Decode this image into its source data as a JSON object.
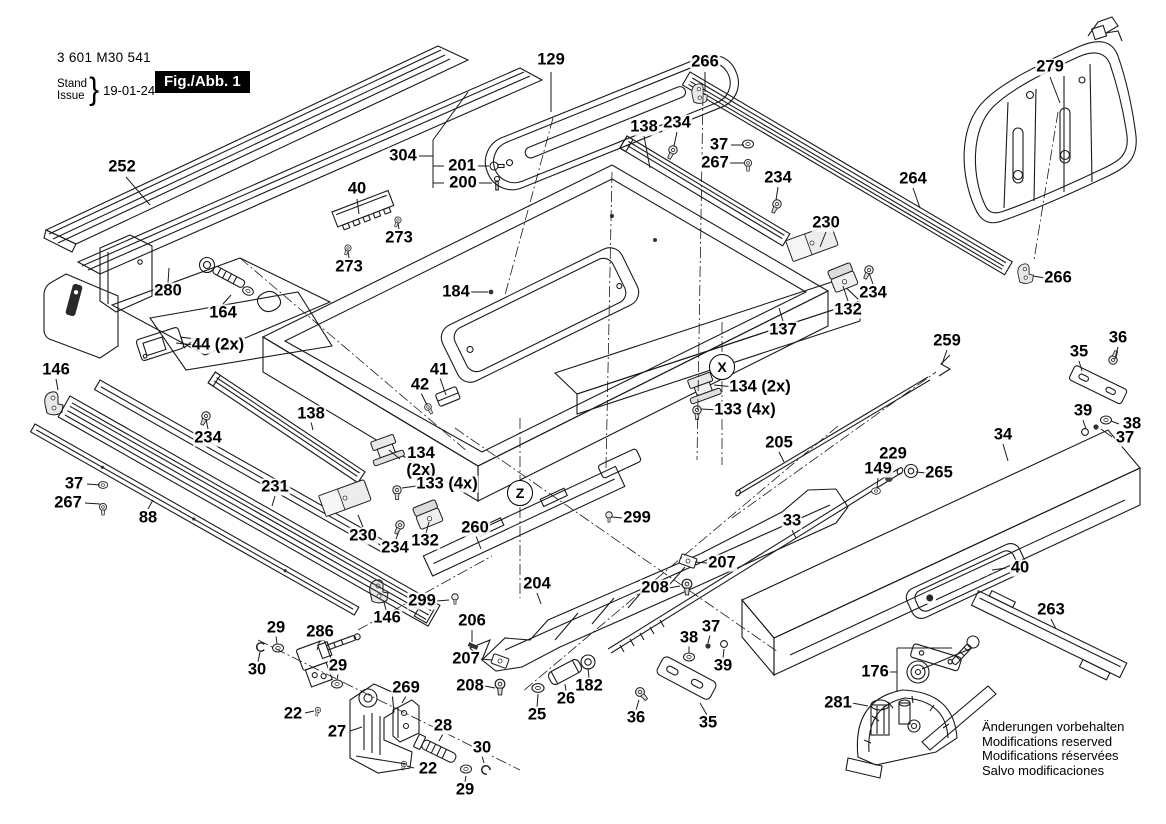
{
  "title_block": {
    "part_number": "3 601 M30 541",
    "stand": "Stand",
    "issue": "Issue",
    "date": "19-01-24",
    "figure": "Fig./Abb. 1"
  },
  "brand": "BOSCH",
  "notes": {
    "lines": [
      "Änderungen vorbehalten",
      "Modifications reserved",
      "Modifications réservées",
      "Salvo modificaciones"
    ]
  },
  "detail_markers": [
    {
      "text": "X",
      "x": 722,
      "y": 367
    },
    {
      "text": "Z",
      "x": 520,
      "y": 493
    }
  ],
  "callouts": [
    {
      "text": "252",
      "x": 122,
      "y": 167
    },
    {
      "text": "129",
      "x": 551,
      "y": 60
    },
    {
      "text": "266",
      "x": 705,
      "y": 62
    },
    {
      "text": "138",
      "x": 644,
      "y": 127
    },
    {
      "text": "234",
      "x": 677,
      "y": 123
    },
    {
      "text": "37",
      "x": 719,
      "y": 145
    },
    {
      "text": "267",
      "x": 715,
      "y": 163
    },
    {
      "text": "279",
      "x": 1050,
      "y": 67
    },
    {
      "text": "264",
      "x": 913,
      "y": 179
    },
    {
      "text": "234",
      "x": 778,
      "y": 178
    },
    {
      "text": "230",
      "x": 826,
      "y": 223
    },
    {
      "text": "266",
      "x": 1058,
      "y": 278
    },
    {
      "text": "234",
      "x": 873,
      "y": 293
    },
    {
      "text": "132",
      "x": 848,
      "y": 310
    },
    {
      "text": "137",
      "x": 783,
      "y": 330
    },
    {
      "text": "304",
      "x": 403,
      "y": 156
    },
    {
      "text": "201",
      "x": 462,
      "y": 166
    },
    {
      "text": "200",
      "x": 463,
      "y": 183
    },
    {
      "text": "40",
      "x": 357,
      "y": 189
    },
    {
      "text": "273",
      "x": 399,
      "y": 238
    },
    {
      "text": "273",
      "x": 349,
      "y": 267
    },
    {
      "text": "280",
      "x": 168,
      "y": 291
    },
    {
      "text": "164",
      "x": 223,
      "y": 313
    },
    {
      "text": "44 (2x)",
      "x": 218,
      "y": 345
    },
    {
      "text": "146",
      "x": 56,
      "y": 370
    },
    {
      "text": "184",
      "x": 456,
      "y": 292
    },
    {
      "text": "41",
      "x": 439,
      "y": 370
    },
    {
      "text": "42",
      "x": 420,
      "y": 385
    },
    {
      "text": "134 (2x)",
      "x": 760,
      "y": 387
    },
    {
      "text": "133 (4x)",
      "x": 745,
      "y": 410
    },
    {
      "text": "259",
      "x": 947,
      "y": 341
    },
    {
      "text": "36",
      "x": 1118,
      "y": 338
    },
    {
      "text": "35",
      "x": 1079,
      "y": 352
    },
    {
      "text": "39",
      "x": 1083,
      "y": 411
    },
    {
      "text": "38",
      "x": 1132,
      "y": 424
    },
    {
      "text": "37",
      "x": 1125,
      "y": 438
    },
    {
      "text": "34",
      "x": 1003,
      "y": 435
    },
    {
      "text": "205",
      "x": 779,
      "y": 443
    },
    {
      "text": "229",
      "x": 893,
      "y": 454
    },
    {
      "text": "149",
      "x": 878,
      "y": 469
    },
    {
      "text": "265",
      "x": 939,
      "y": 473
    },
    {
      "text": "33",
      "x": 792,
      "y": 521
    },
    {
      "text": "138",
      "x": 311,
      "y": 414
    },
    {
      "text": "234",
      "x": 208,
      "y": 438
    },
    {
      "text": "134\n(2x)",
      "x": 421,
      "y": 462
    },
    {
      "text": "133 (4x)",
      "x": 447,
      "y": 484
    },
    {
      "text": "37",
      "x": 74,
      "y": 484
    },
    {
      "text": "267",
      "x": 68,
      "y": 503
    },
    {
      "text": "88",
      "x": 148,
      "y": 518
    },
    {
      "text": "231",
      "x": 275,
      "y": 487
    },
    {
      "text": "230",
      "x": 363,
      "y": 536
    },
    {
      "text": "234",
      "x": 395,
      "y": 548
    },
    {
      "text": "132",
      "x": 425,
      "y": 541
    },
    {
      "text": "299",
      "x": 422,
      "y": 601
    },
    {
      "text": "260",
      "x": 475,
      "y": 528
    },
    {
      "text": "299",
      "x": 637,
      "y": 518
    },
    {
      "text": "204",
      "x": 537,
      "y": 584
    },
    {
      "text": "207",
      "x": 722,
      "y": 563
    },
    {
      "text": "208",
      "x": 655,
      "y": 588
    },
    {
      "text": "206",
      "x": 472,
      "y": 621
    },
    {
      "text": "207",
      "x": 466,
      "y": 659
    },
    {
      "text": "208",
      "x": 470,
      "y": 686
    },
    {
      "text": "146",
      "x": 387,
      "y": 618
    },
    {
      "text": "29",
      "x": 276,
      "y": 628
    },
    {
      "text": "286",
      "x": 320,
      "y": 632
    },
    {
      "text": "30",
      "x": 257,
      "y": 670
    },
    {
      "text": "29",
      "x": 338,
      "y": 666
    },
    {
      "text": "22",
      "x": 293,
      "y": 714
    },
    {
      "text": "27",
      "x": 337,
      "y": 732
    },
    {
      "text": "269",
      "x": 406,
      "y": 688
    },
    {
      "text": "28",
      "x": 443,
      "y": 726
    },
    {
      "text": "22",
      "x": 428,
      "y": 769
    },
    {
      "text": "30",
      "x": 482,
      "y": 748
    },
    {
      "text": "29",
      "x": 465,
      "y": 790
    },
    {
      "text": "25",
      "x": 537,
      "y": 715
    },
    {
      "text": "26",
      "x": 566,
      "y": 699
    },
    {
      "text": "182",
      "x": 589,
      "y": 686
    },
    {
      "text": "36",
      "x": 636,
      "y": 718
    },
    {
      "text": "35",
      "x": 708,
      "y": 723
    },
    {
      "text": "38",
      "x": 689,
      "y": 638
    },
    {
      "text": "37",
      "x": 711,
      "y": 627
    },
    {
      "text": "39",
      "x": 723,
      "y": 666
    },
    {
      "text": "40",
      "x": 1020,
      "y": 568
    },
    {
      "text": "263",
      "x": 1051,
      "y": 610
    },
    {
      "text": "176",
      "x": 875,
      "y": 672
    },
    {
      "text": "281",
      "x": 838,
      "y": 703
    }
  ]
}
